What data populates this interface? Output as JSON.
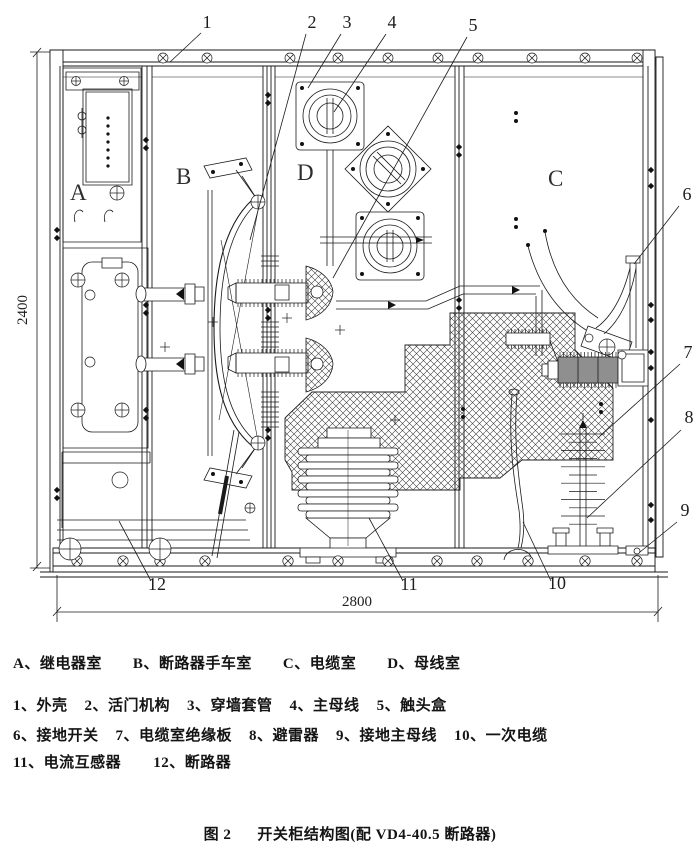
{
  "drawing": {
    "compartment_labels": [
      {
        "id": "A",
        "x": 70,
        "y": 200
      },
      {
        "id": "B",
        "x": 176,
        "y": 184
      },
      {
        "id": "D",
        "x": 297,
        "y": 180
      },
      {
        "id": "C",
        "x": 548,
        "y": 186
      }
    ],
    "callouts": [
      {
        "num": "1",
        "tx": 207,
        "ty": 28,
        "x1": 201,
        "y1": 33,
        "x2": 170,
        "y2": 62
      },
      {
        "num": "2",
        "tx": 312,
        "ty": 28,
        "x1": 306,
        "y1": 34,
        "x2": 250,
        "y2": 240
      },
      {
        "num": "3",
        "tx": 347,
        "ty": 28,
        "x1": 341,
        "y1": 34,
        "x2": 308,
        "y2": 88
      },
      {
        "num": "4",
        "tx": 392,
        "ty": 28,
        "x1": 386,
        "y1": 34,
        "x2": 334,
        "y2": 112
      },
      {
        "num": "5",
        "tx": 473,
        "ty": 31,
        "x1": 467,
        "y1": 37,
        "x2": 333,
        "y2": 278
      },
      {
        "num": "6",
        "tx": 687,
        "ty": 200,
        "x1": 679,
        "y1": 206,
        "x2": 634,
        "y2": 264
      },
      {
        "num": "7",
        "tx": 688,
        "ty": 358,
        "x1": 680,
        "y1": 364,
        "x2": 598,
        "y2": 438
      },
      {
        "num": "8",
        "tx": 689,
        "ty": 423,
        "x1": 681,
        "y1": 430,
        "x2": 587,
        "y2": 518
      },
      {
        "num": "9",
        "tx": 685,
        "ty": 516,
        "x1": 677,
        "y1": 522,
        "x2": 640,
        "y2": 552
      },
      {
        "num": "10",
        "tx": 557,
        "ty": 589,
        "x1": 551,
        "y1": 581,
        "x2": 523,
        "y2": 522
      },
      {
        "num": "11",
        "tx": 409,
        "ty": 590,
        "x1": 403,
        "y1": 581,
        "x2": 369,
        "y2": 518
      },
      {
        "num": "12",
        "tx": 157,
        "ty": 590,
        "x1": 151,
        "y1": 581,
        "x2": 119,
        "y2": 521
      }
    ],
    "dim_height": {
      "label": "2400",
      "x": 27,
      "y": 310
    },
    "dim_width": {
      "label": "2800",
      "x": 357,
      "y": 606
    }
  },
  "legend": {
    "rooms": [
      "A、继电器室",
      "B、断路器手车室",
      "C、电缆室",
      "D、母线室"
    ],
    "parts_row1": [
      "1、外壳",
      "2、活门机构",
      "3、穿墙套管",
      "4、主母线",
      "5、触头盒"
    ],
    "parts_row2": [
      "6、接地开关",
      "7、电缆室绝缘板",
      "8、避雷器",
      "9、接地主母线",
      "10、一次电缆"
    ],
    "parts_row3": [
      "11、电流互感器",
      "12、断路器"
    ]
  },
  "caption": {
    "figure_no": "图 2",
    "text": "开关柜结构图(配 VD4-40.5 断路器)"
  }
}
